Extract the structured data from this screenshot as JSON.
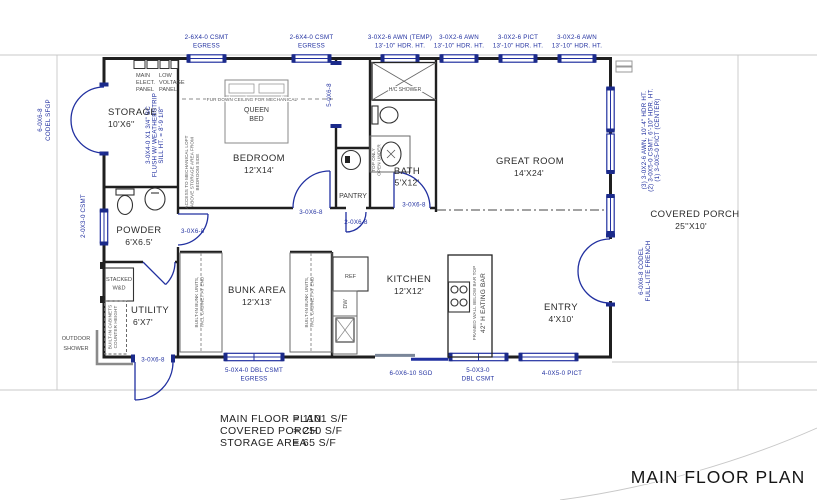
{
  "colors": {
    "accent_blue": "#2130a0",
    "wall_black": "#1f1f1f",
    "annotation_gray": "#5a5a5a",
    "faint_line": "#c8c8c8"
  },
  "title": "MAIN FLOOR PLAN",
  "summary": {
    "rows": [
      {
        "label": "MAIN FLOOR PLAN",
        "value": "= 1101 S/F"
      },
      {
        "label": "COVERED PORCH",
        "value": "= 250 S/F"
      },
      {
        "label": "STORAGE AREA",
        "value": "=  65 S/F"
      }
    ]
  },
  "rooms": {
    "storage": {
      "name": "STORAGE",
      "size": "10'X6''"
    },
    "powder": {
      "name": "POWDER",
      "size": "6'X6.5'"
    },
    "utility": {
      "name": "UTILITY",
      "size": "6'X7'"
    },
    "bedroom": {
      "name": "BEDROOM",
      "size": "12'X14'"
    },
    "bath": {
      "name": "BATH",
      "size": "5'X12'"
    },
    "pantry": {
      "name": "PANTRY"
    },
    "bunk": {
      "name": "BUNK AREA",
      "size": "12'X13'"
    },
    "kitchen": {
      "name": "KITCHEN",
      "size": "12'X12'"
    },
    "great_room": {
      "name": "GREAT ROOM",
      "size": "14'X24'"
    },
    "entry": {
      "name": "ENTRY",
      "size": "4'X10'"
    },
    "porch": {
      "name": "COVERED PORCH",
      "size": "25''X10'"
    }
  },
  "openings": {
    "csmt_egress": {
      "l1": "2-6X4-0 CSMT",
      "l2": "EGRESS"
    },
    "awn_temp": {
      "l1": "3-0X2-6 AWN (TEMP)",
      "l2": "13'-10\" HDR. HT."
    },
    "awn": {
      "l1": "3-0X2-6 AWN",
      "l2": "13'-10\" HDR. HT."
    },
    "pict": {
      "l1": "3-0X2-6 PICT",
      "l2": "13'-10\" HDR. HT."
    },
    "storage_door": {
      "l1": "6-0X6-8",
      "l2": "CODEL SFGP"
    },
    "powder_window": "2-0X3-0 CSMT",
    "loft_door": {
      "l1": "3-0X4-0 X1 3/4\" SC",
      "l2": "FLUSH W/ WEATHERSTRIP",
      "l3": "SILL HT. = 8'-9 1/8\""
    },
    "closet_opening": "5-0X6-8",
    "bedroom_door": "3-0X6-8",
    "powder_door": "3-0X6-8",
    "pantry_door": "2-0X6-8",
    "bath_door": "3-0X6-8",
    "utility_door": "3-0X6-8",
    "bunk_window": {
      "l1": "5-0X4-0 DBL CSMT",
      "l2": "EGRESS"
    },
    "patio_door": "6-0X6-10 SGD",
    "kitchen_window": {
      "l1": "5-0X3-0",
      "l2": "DBL CSMT"
    },
    "entry_window": "4-0X5-0 PICT",
    "entry_door": {
      "l1": "6-0X6-8 CODEL",
      "l2": "FULL-LITE FRENCH"
    },
    "window_wall_note": {
      "l1": "(3) 3-0X2-6 AWN, 10'-4\" HDR HT.",
      "l2": "(2) 3-0X5-0 CSMT, 6'-10\" HDR. HT.",
      "l3": "(1) 3-0X5-0 PICT (CENTER)"
    }
  },
  "annotations": {
    "main_panel": {
      "l1": "MAIN",
      "l2": "ELECT.",
      "l3": "PANEL"
    },
    "low_voltage_panel": {
      "l1": "LOW",
      "l2": "VOLTAGE",
      "l3": "PANEL"
    },
    "fur_down": "FUR DOWN CEILING FOR MECHANICAL",
    "loft_access": {
      "l1": "ACCESS TO MECHANICAL LOFT",
      "l2": "ABOVE STORAGE AREA FROM",
      "l3": "BEDROOM SIDE"
    },
    "queen_bed": {
      "l1": "QUEEN",
      "l2": "BED"
    },
    "hc_shower": "H/C SHOWER",
    "vanity_note": {
      "l1": "TOP ONLY",
      "l2": "OPEN UNDER"
    },
    "stacked_wd": {
      "l1": "STACKED",
      "l2": "W&D"
    },
    "outdoor_shower": {
      "l1": "OUTDOOR",
      "l2": "SHOWER"
    },
    "builtin_cabinets": {
      "l1": "BUILT-IN CABINETS",
      "l2": "COUNTER HEIGHT"
    },
    "bunk_units": {
      "l1": "BUILT-IN BUNK UNITS,",
      "l2": "TALL CABINET AT END"
    },
    "ref": "REF",
    "dw": "DW",
    "framed_wall": "FRAMED WALL BELOW BAR TOP",
    "eating_bar": "42\" H EATING BAR"
  }
}
